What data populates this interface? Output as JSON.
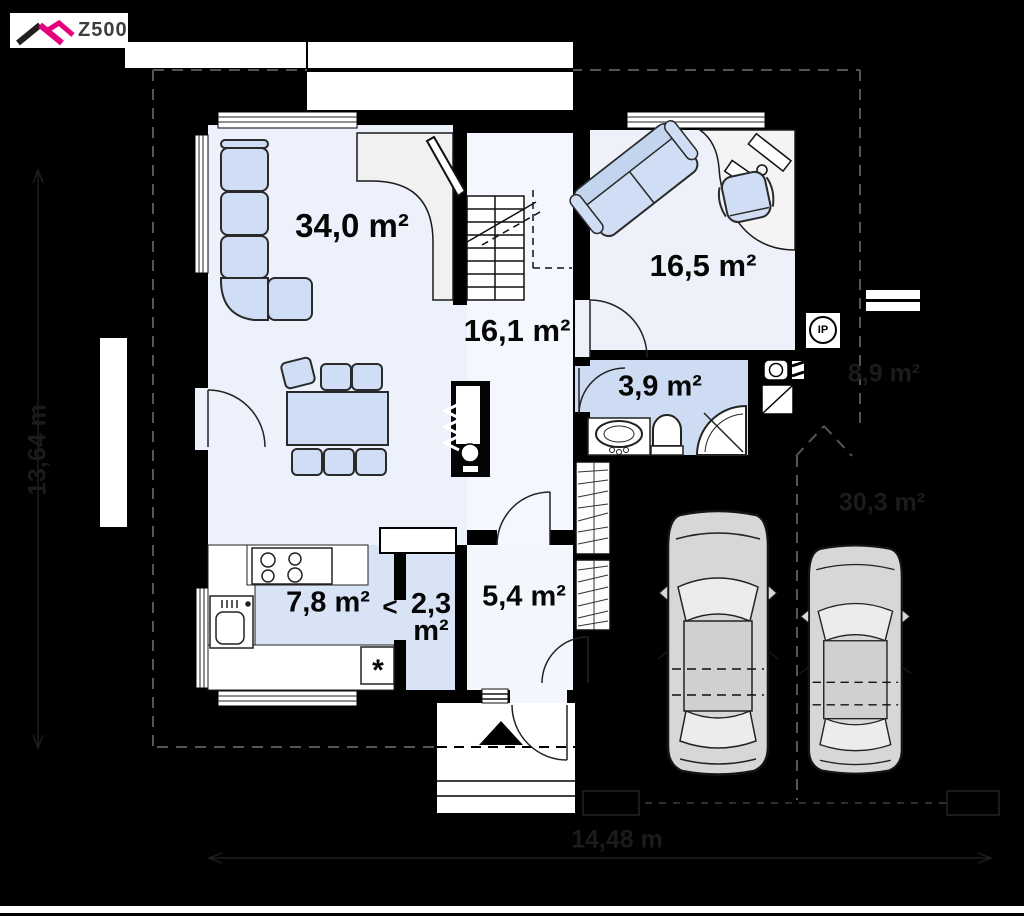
{
  "logo": {
    "text": "Z500",
    "accent_color": "#e6007e"
  },
  "rooms": {
    "living": {
      "name": "living-room",
      "label": "34,0 m²"
    },
    "office": {
      "name": "room",
      "label": "16,5 m²"
    },
    "hall": {
      "name": "hall-stairs",
      "label": "16,1 m²"
    },
    "bathroom": {
      "name": "bathroom",
      "label": "3,9 m²"
    },
    "kitchen": {
      "name": "kitchen",
      "label": "7,8 m²"
    },
    "pantry": {
      "name": "pantry",
      "label_value": "2,3",
      "label_unit": "m²"
    },
    "vestibule": {
      "name": "vestibule",
      "label": "5,4 m²"
    }
  },
  "badges": {
    "ip": "IP",
    "fridge": "*",
    "pantry_arrow": "<"
  },
  "hidden_annotations": {
    "terrace_area": "8,9 m²",
    "parking_area": "30,3 m²",
    "total_width": "14,48 m",
    "total_depth": "13,64 m"
  },
  "colors": {
    "background": "#000000",
    "floor_light": "#ecf1fb",
    "floor_wet": "#cddcf3",
    "kitchen_floor": "#d8e3f5",
    "furniture_fill": "#cfdef4",
    "car_body": "#d7d7d7",
    "logo_accent": "#e6007e"
  }
}
